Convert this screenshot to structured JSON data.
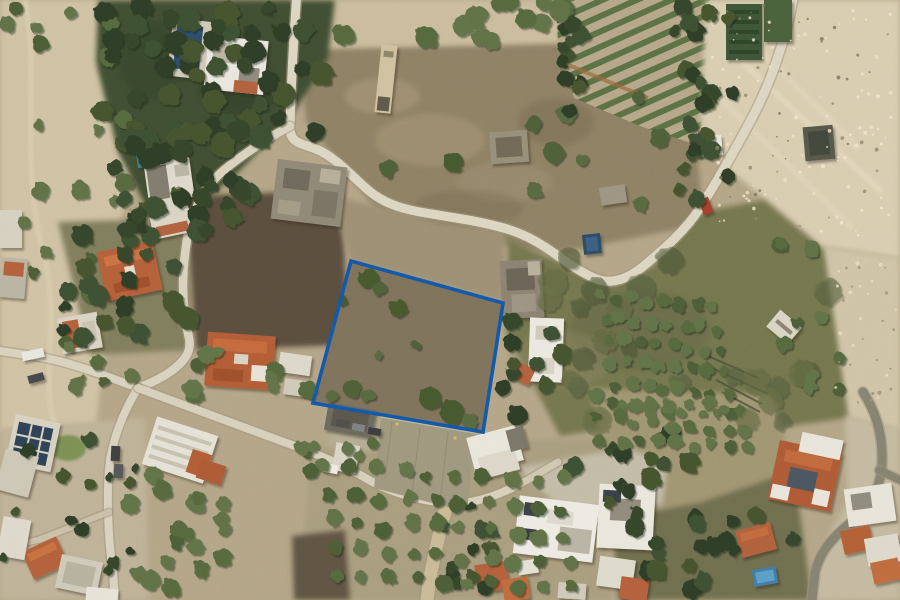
{
  "view": {
    "type": "aerial-satellite-photo",
    "title": "Satellite view of land plot",
    "description": "Top-down aerial photograph of a Mediterranean semi-rural neighborhood with olive groves, a vineyard, dry rocky fields, tilled plots, winding pale roads and scattered houses with terracotta and white roofs. A quadrilateral land plot near the center is outlined in blue.",
    "width_px": 900,
    "height_px": 600
  },
  "overlay": {
    "label": "plot-boundary",
    "shape": "quadrilateral",
    "points": "351,261 503,303 483,432 313,403",
    "stroke_color": "#1257a8",
    "stroke_width": 3.6,
    "fill": "none"
  },
  "palette": {
    "ground": "#b3a486",
    "dry_rocky_field": "#d8ccb0",
    "tilled_field_dark": "#5a4e3e",
    "forest_green": "#3f4e33",
    "road_pale": "#dcd5c0",
    "asphalt": "#85816f",
    "roof_terracotta": "#b25c35",
    "roof_white": "#e9e6de",
    "pool_dark_blue": "#2e4d6d",
    "boundary_blue": "#1257a8"
  }
}
